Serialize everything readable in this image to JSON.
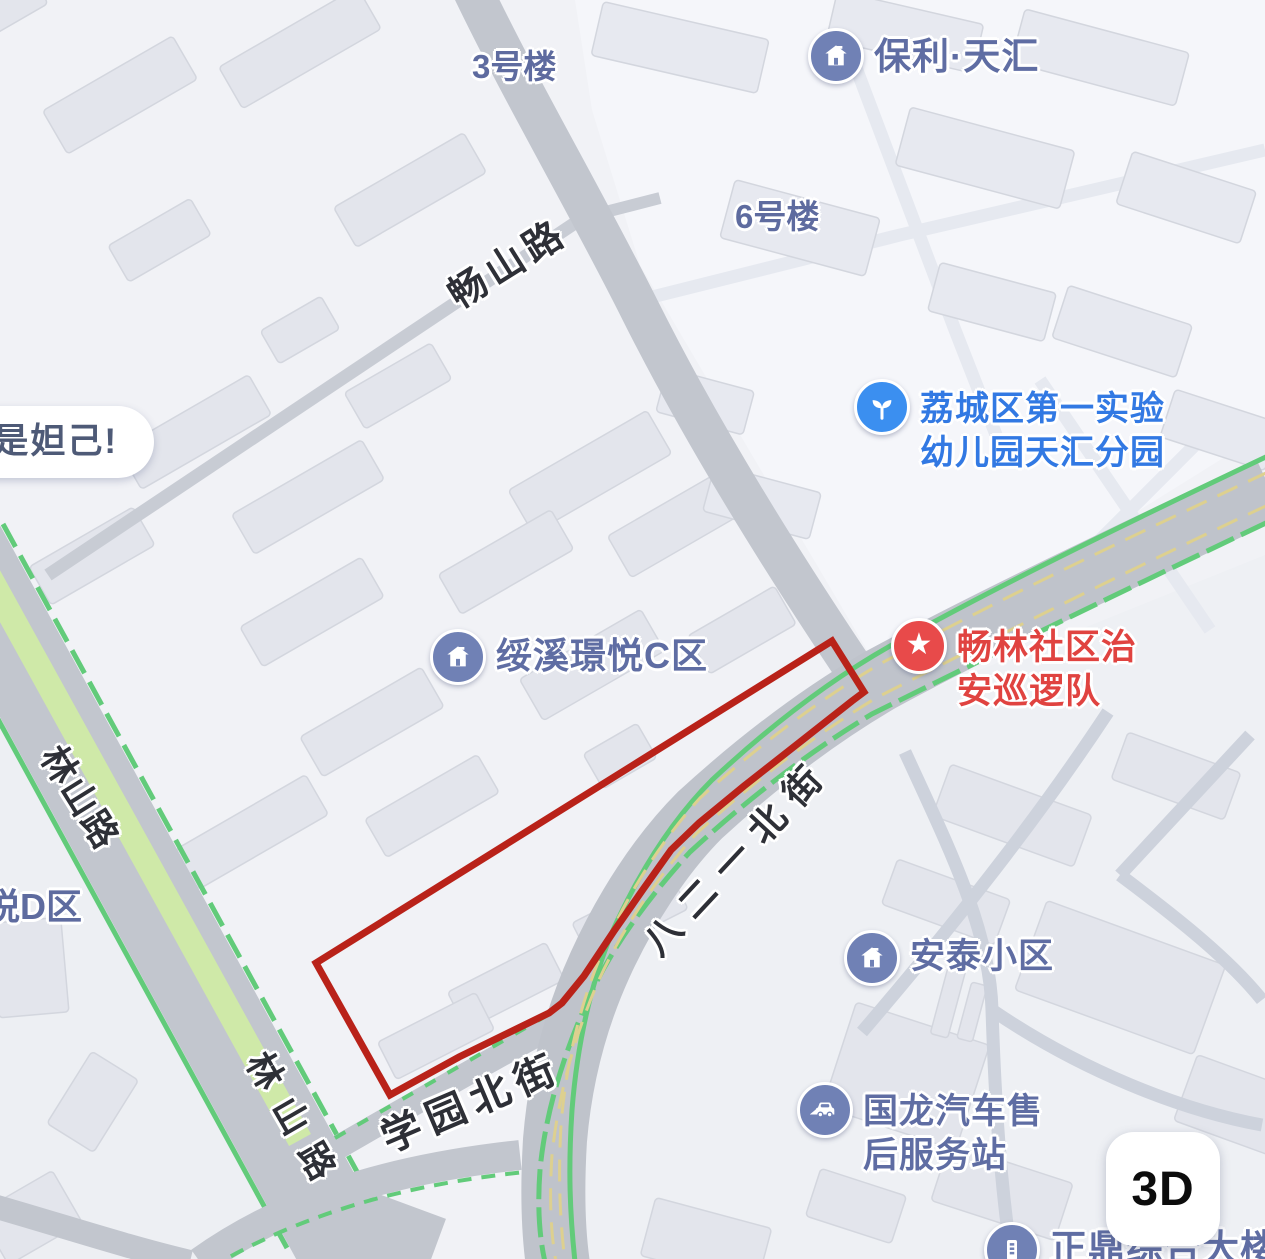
{
  "map": {
    "speech_bubble": {
      "text": "是妲己!"
    },
    "controls": {
      "threed_button": "3D"
    },
    "roads": {
      "changshan": "畅山路",
      "linshan_upper": "林山路",
      "linshan_lower": "林山路",
      "bayiyi_north": "八二一北街",
      "xueyuan_north": "学园北街"
    },
    "pois": {
      "baoli_tianhui": {
        "label": "保利·天汇",
        "icon": "house-icon"
      },
      "building_3": {
        "label": "3号楼"
      },
      "building_6": {
        "label": "6号楼"
      },
      "kindergarten": {
        "line1": "荔城区第一实验",
        "line2": "幼儿园天汇分园",
        "icon": "sprout-icon"
      },
      "suixi_jingyue_c": {
        "label": "绥溪璟悦C区",
        "icon": "house-icon"
      },
      "patrol_team": {
        "line1": "畅林社区治",
        "line2": "安巡逻队",
        "icon": "star-icon"
      },
      "antai": {
        "label": "安泰小区",
        "icon": "house-icon"
      },
      "guolong": {
        "line1": "国龙汽车售",
        "line2": "后服务站",
        "icon": "car-icon"
      },
      "zhengding": {
        "label": "正鼎综合大楼",
        "icon": "building-icon"
      },
      "yue_d_district": {
        "label": "悦D区"
      }
    },
    "colors": {
      "highlight_polygon": "#b92219",
      "poi_blue": "#5f6da3",
      "poi_bright_blue": "#3279e3",
      "poi_red": "#e04340",
      "poi_badge_blue": "#7081b5",
      "poi_badge_bright_blue": "#3b8ff0",
      "poi_badge_red": "#e84a4a",
      "road_fill": "#c2c6ce",
      "road_edge_green": "#62cb7a",
      "road_median_green": "#cfe9a8",
      "lane_yellow": "#ddd08f"
    }
  }
}
